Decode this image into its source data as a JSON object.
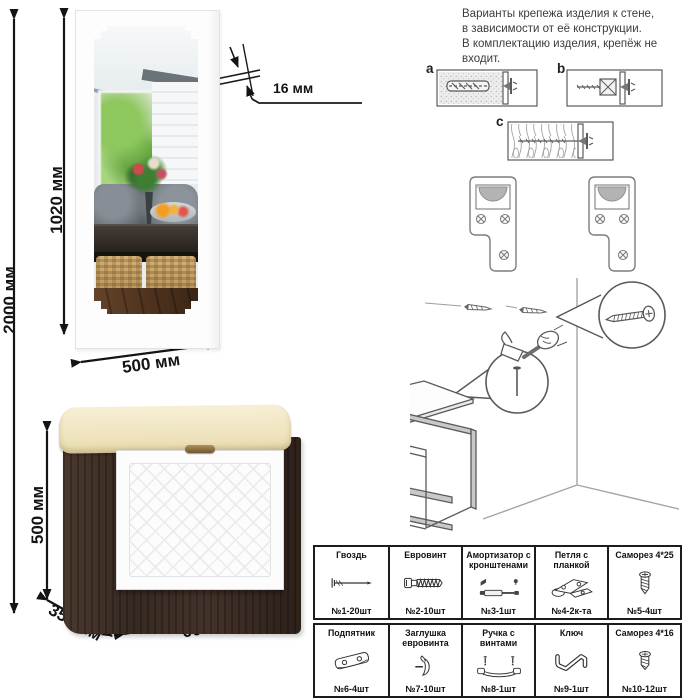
{
  "note": {
    "text": "Варианты крепежа изделия к стене,\nв зависимости от её конструкции.\nВ комплектацию изделия, крепёж не\nвходит."
  },
  "dimensions": {
    "overall_height": "2000 мм",
    "mirror_height": "1020 мм",
    "mirror_width": "500 мм",
    "mirror_thickness": "16 мм",
    "bench_height": "500 мм",
    "bench_depth": "350 мм",
    "bench_width": "600 мм"
  },
  "wall_fixing": {
    "option_a": "a",
    "option_b": "b",
    "option_c": "c"
  },
  "hardware": {
    "items": [
      {
        "name": "Гвоздь",
        "qty": "№1-20шт",
        "icon": "nail-icon"
      },
      {
        "name": "Евровинт",
        "qty": "№2-10шт",
        "icon": "euro-screw-icon"
      },
      {
        "name": "Амортизатор с кронштенами",
        "qty": "№3-1шт",
        "icon": "gas-lift-icon"
      },
      {
        "name": "Петля с планкой",
        "qty": "№4-2к-та",
        "icon": "hinge-icon"
      },
      {
        "name": "Саморез 4*25",
        "qty": "№5-4шт",
        "icon": "long-screw-icon"
      },
      {
        "name": "Подпятник",
        "qty": "№6-4шт",
        "icon": "foot-glide-icon"
      },
      {
        "name": "Заглушка евровинта",
        "qty": "№7-10шт",
        "icon": "screw-cap-icon"
      },
      {
        "name": "Ручка с винтами",
        "qty": "№8-1шт",
        "icon": "handle-icon"
      },
      {
        "name": "Ключ",
        "qty": "№9-1шт",
        "icon": "hex-key-icon"
      },
      {
        "name": "Саморез 4*16",
        "qty": "№10-12шт",
        "icon": "short-screw-icon"
      }
    ]
  },
  "colors": {
    "bench_body": "#3a2b23",
    "bench_cushion": "#f2e7c4",
    "facade": "#fcfcfc",
    "line_art": "#555555",
    "dimension_lines": "#141414"
  }
}
